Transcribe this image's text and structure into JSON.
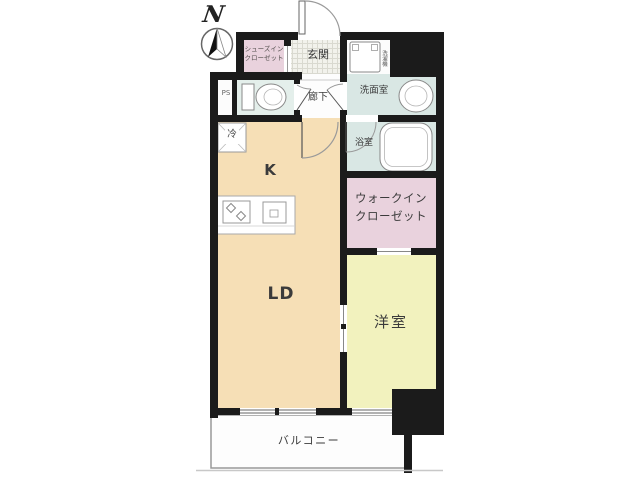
{
  "compass": {
    "north_label": "N"
  },
  "rooms": {
    "shoe_closet": {
      "line1": "シューズイン",
      "line2": "クローゼット"
    },
    "entrance": {
      "label": "玄関"
    },
    "hallway": {
      "label": "廊下"
    },
    "pipe_space": {
      "label": "PS"
    },
    "washroom": {
      "label": "洗面室"
    },
    "bathroom": {
      "label": "浴室"
    },
    "kitchen": {
      "label": "K"
    },
    "living_dining": {
      "label": "LD"
    },
    "walk_in_closet": {
      "line1": "ウォークイン",
      "line2": "クローゼット"
    },
    "western_room": {
      "label": "洋室"
    },
    "balcony": {
      "label": "バルコニー"
    }
  },
  "fixtures": {
    "refrigerator_label": "冷",
    "washing_machine_label": "洗濯機"
  },
  "colors": {
    "wall": "#1b1b1b",
    "ldk-floor": "#f6dfb6",
    "western-room-floor": "#f2f2be",
    "closet-pink": "#e9d2dd",
    "wet-area-blue": "#d9e7e4",
    "toilet-floor": "#e4efeb",
    "label-text": "#3b3b3b"
  }
}
